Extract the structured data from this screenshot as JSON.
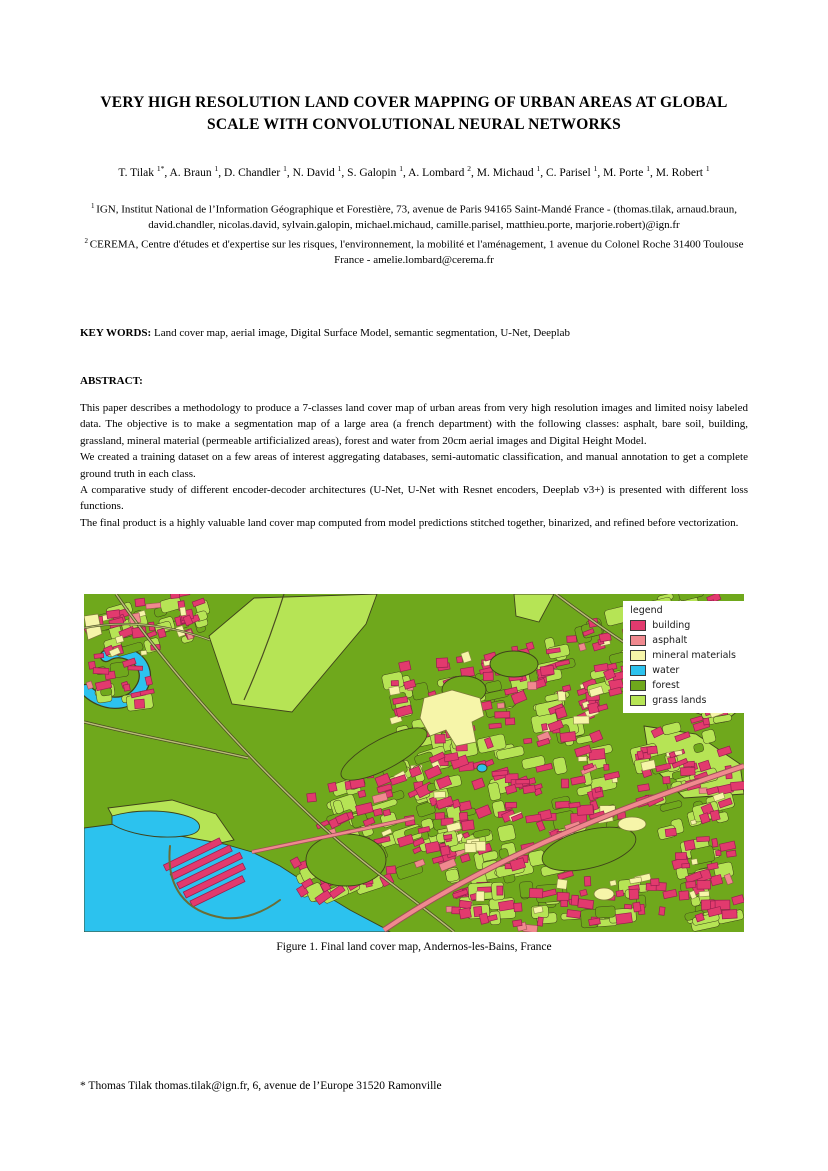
{
  "paper": {
    "title_lines": [
      "VERY HIGH RESOLUTION LAND COVER MAPPING OF URBAN AREAS AT GLOBAL",
      "SCALE WITH CONVOLUTIONAL NEURAL NETWORKS"
    ],
    "authors": [
      {
        "name": "T. Tilak",
        "sup": "1*"
      },
      {
        "name": "A. Braun",
        "sup": "1"
      },
      {
        "name": "D. Chandler",
        "sup": "1"
      },
      {
        "name": "N. David",
        "sup": "1"
      },
      {
        "name": "S. Galopin",
        "sup": "1"
      },
      {
        "name": "A. Lombard",
        "sup": "2"
      },
      {
        "name": "M. Michaud",
        "sup": "1"
      },
      {
        "name": "C. Parisel",
        "sup": "1"
      },
      {
        "name": "M. Porte",
        "sup": "1"
      },
      {
        "name": "M. Robert",
        "sup": "1"
      }
    ],
    "affiliations": [
      {
        "sup": "1",
        "text": "IGN, Institut National de l’Information Géographique et Forestière, 73, avenue de Paris 94165 Saint-Mandé France - (thomas.tilak, arnaud.braun, david.chandler, nicolas.david, sylvain.galopin, michael.michaud, camille.parisel, matthieu.porte, marjorie.robert)@ign.fr"
      },
      {
        "sup": "2",
        "text": "CEREMA, Centre d'études et d'expertise sur les risques, l'environnement, la mobilité et l'aménagement, 1 avenue du Colonel Roche 31400 Toulouse France - amelie.lombard@cerema.fr"
      }
    ],
    "keywords_label": "KEY WORDS:",
    "keywords": "Land cover map, aerial image, Digital Surface Model, semantic segmentation, U-Net, Deeplab",
    "abstract_label": "ABSTRACT:",
    "abstract_paragraphs": [
      "This paper describes a methodology to produce a 7-classes land cover map of urban areas from very high resolution images and limited noisy labeled data. The objective is to make a segmentation map of a large area (a french department) with the following classes: asphalt, bare soil, building, grassland, mineral material (permeable artificialized areas), forest and water from 20cm aerial images and Digital Height Model.",
      "We created a training dataset on a few areas of interest aggregating databases, semi-automatic classification, and manual annotation to get a complete ground truth in each class.",
      "A comparative study of different encoder-decoder architectures (U-Net, U-Net with Resnet encoders, Deeplab v3+) is presented with different loss functions.",
      "The final product is a highly valuable land cover map computed from model predictions stitched together, binarized, and refined before vectorization."
    ],
    "footnote": "* Thomas Tilak thomas.tilak@ign.fr,  6, avenue de l’Europe 31520 Ramonville"
  },
  "figure": {
    "caption": "Figure 1. Final land cover map, Andernos-les-Bains, France",
    "legend": {
      "title": "legend",
      "entries": [
        {
          "key": "building",
          "label": "building",
          "color": "#e23a6e"
        },
        {
          "key": "asphalt",
          "label": "asphalt",
          "color": "#f0898f"
        },
        {
          "key": "mineral",
          "label": "mineral materials",
          "color": "#f6f5a9"
        },
        {
          "key": "water",
          "label": "water",
          "color": "#2cc2ee"
        },
        {
          "key": "forest",
          "label": "forest",
          "color": "#6fa81c"
        },
        {
          "key": "grass",
          "label": "grass lands",
          "color": "#b6e455"
        }
      ]
    }
  }
}
